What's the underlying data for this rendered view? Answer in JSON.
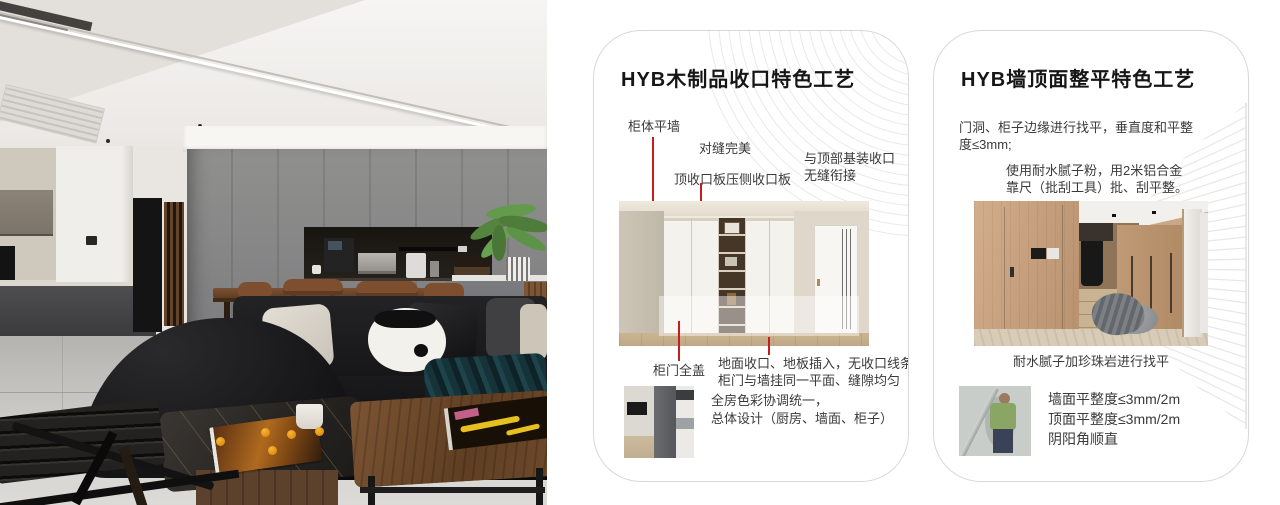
{
  "colors": {
    "accent_red": "#c41e1e",
    "card_border": "#d8d8d8",
    "pattern_gray": "#e9e9e9"
  },
  "cards": [
    {
      "title": "HYB木制品收口特色工艺",
      "callouts": {
        "cabinet_flush_wall": "柜体平墙",
        "perfect_seam": "对缝完美",
        "top_closing_board": "顶收口板压侧收口板",
        "top_joint_line1": "与顶部基装收口",
        "top_joint_line2": "无缝衔接",
        "door_full_cover": "柜门全盖",
        "floor_line1": "地面收口、地板插入，无收口线条",
        "floor_line2": "柜门与墙挂同一平面、缝隙均匀"
      },
      "notes": {
        "line1": "全房色彩协调统一，",
        "line2": "总体设计（厨房、墙面、柜子）"
      }
    },
    {
      "title": "HYB墙顶面整平特色工艺",
      "paragraphs": {
        "p1_line1": "门洞、柜子边缘进行找平，垂直度和平整",
        "p1_line2": "度≤3mm;",
        "p2_line1": "使用耐水腻子粉，用2米铝合金",
        "p2_line2": "靠尺（批刮工具）批、刮平整。"
      },
      "caption": "耐水腻子加珍珠岩进行找平",
      "specs": {
        "line1": "墙面平整度≤3mm/2m",
        "line2": "顶面平整度≤3mm/2m",
        "line3": "阴阳角顺直"
      }
    }
  ]
}
